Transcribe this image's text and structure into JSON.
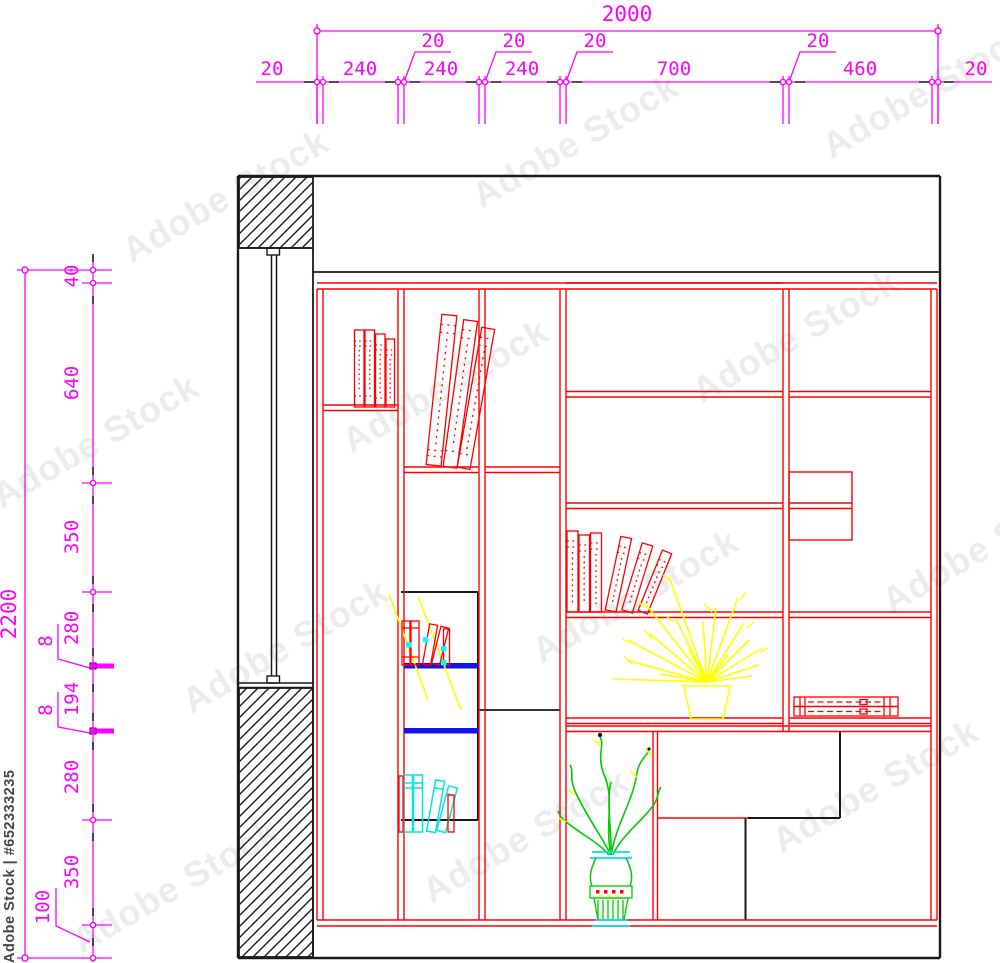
{
  "dimensions": {
    "top": {
      "overall": "2000",
      "row": [
        "20",
        "240",
        "240",
        "240",
        "700",
        "460",
        "20"
      ],
      "small": [
        "20",
        "20",
        "20",
        "20"
      ]
    },
    "left": {
      "overall": "2200",
      "row": [
        "40",
        "640",
        "350",
        "280",
        "194",
        "280",
        "350"
      ],
      "small": [
        "8",
        "8",
        "100"
      ]
    }
  },
  "watermark": {
    "brand": "Adobe Stock",
    "id_label": "Adobe Stock | #652333235"
  },
  "colors": {
    "dimension": "#FF00FF",
    "structure": "#1A1A1A",
    "furniture": "#FF0000",
    "shelf_accent": "#1313E8",
    "books_accent": "#00E5E5",
    "plant_yellow": "#FFFF00",
    "plant_green": "#00CC00"
  }
}
